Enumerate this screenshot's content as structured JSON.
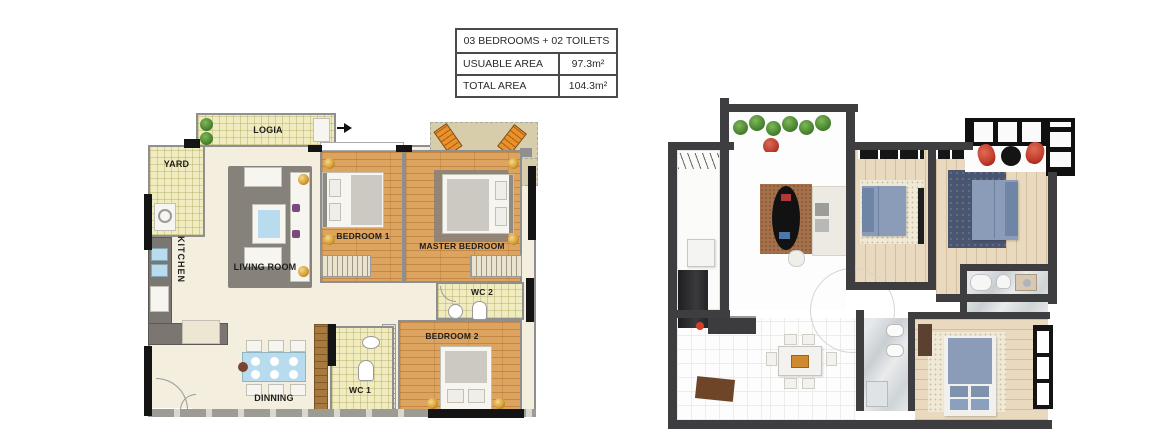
{
  "info_table": {
    "header": "03 BEDROOMS + 02 TOILETS",
    "rows": [
      {
        "label": "USUABLE AREA",
        "value": "97.3m²"
      },
      {
        "label": "TOTAL AREA",
        "value": "104.3m²"
      }
    ]
  },
  "plan_2d": {
    "labels": {
      "logia": "LOGIA",
      "yard": "YARD",
      "kitchen": "KITCHEN",
      "living_room": "LIVING ROOM",
      "bedroom1": "BEDROOM 1",
      "master_bedroom": "MASTER BEDROOM",
      "wc2": "WC 2",
      "wc1": "WC 1",
      "bedroom2": "BEDROOM 2",
      "dinning": "DINNING"
    }
  },
  "colors": {
    "table-border": "#4a4a4a",
    "text": "#1d1d1d",
    "wall-dark": "#3e3e40",
    "wall-gray": "#8f8f8f",
    "wall-black": "#141414",
    "floor-cream": "#f4eede",
    "floor-yellow": "#f1ecc0",
    "floor-wood": "#dca45f",
    "floor-wood-light": "#e9dabf",
    "balcony-tan": "#d8cdab",
    "rug-gray": "#87817b",
    "rug-brown": "#a5714b",
    "rug-dark-blue": "#4a5670",
    "rug-shag": "#efe9d6",
    "bed-blue": "#8a9cb8",
    "water-blue": "#b8dced",
    "accent-gold": "#d29a2e",
    "accent-orange": "#e8922c",
    "accent-red": "#c23b2b",
    "plant-green": "#4d8a33"
  }
}
